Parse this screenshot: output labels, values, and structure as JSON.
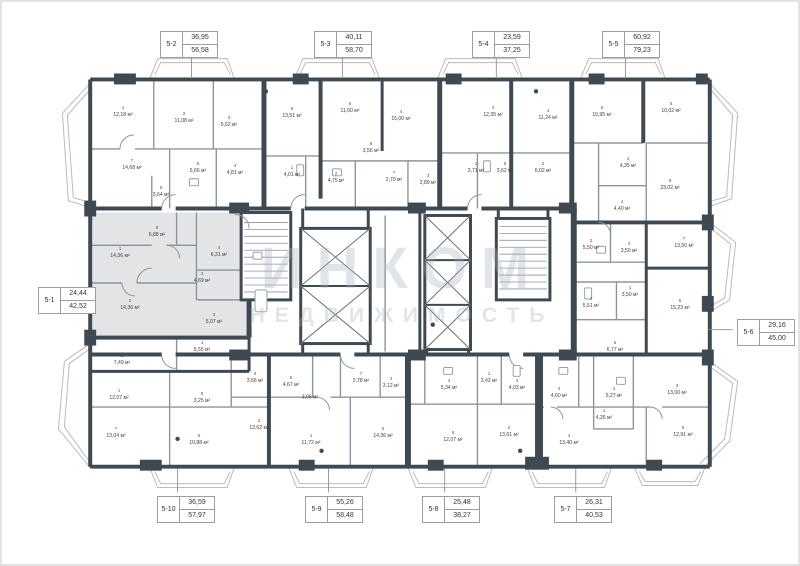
{
  "watermark": {
    "line1": "ИНКОМ",
    "line2": "НЕДВИЖИМОСТЬ"
  },
  "colors": {
    "wall": "#3e4951",
    "line": "#8d959c",
    "balcony": "#b6bcc2",
    "highlight": "#e3e4e6",
    "callout_border": "#9e9e9e",
    "watermark": "#a8b3bf"
  },
  "callouts": [
    {
      "id": "5-2",
      "top": "36,95",
      "bottom": "56,58",
      "x": 158,
      "y": 29,
      "leader": [
        190,
        55,
        190,
        77
      ]
    },
    {
      "id": "5-3",
      "top": "40,11",
      "bottom": "58,70",
      "x": 312,
      "y": 29,
      "leader": [
        342,
        55,
        342,
        77
      ]
    },
    {
      "id": "5-4",
      "top": "23,59",
      "bottom": "37,25",
      "x": 470,
      "y": 29,
      "leader": [
        497,
        55,
        497,
        77
      ]
    },
    {
      "id": "5-5",
      "top": "60,92",
      "bottom": "79,23",
      "x": 600,
      "y": 29,
      "leader": [
        627,
        55,
        627,
        77
      ]
    },
    {
      "id": "5-1",
      "top": "24,44",
      "bottom": "42,52",
      "x": 36,
      "y": 285,
      "leader": [
        92,
        298,
        87,
        298
      ]
    },
    {
      "id": "5-6",
      "top": "29,16",
      "bottom": "45,00",
      "x": 735,
      "y": 317,
      "leader": [
        735,
        330,
        711,
        330
      ]
    },
    {
      "id": "5-10",
      "top": "36,59",
      "bottom": "57,97",
      "x": 155,
      "y": 494,
      "leader": [
        176,
        494,
        176,
        470
      ]
    },
    {
      "id": "5-9",
      "top": "55,26",
      "bottom": "58,48",
      "x": 303,
      "y": 494,
      "leader": [
        328,
        494,
        328,
        470
      ]
    },
    {
      "id": "5-8",
      "top": "25,48",
      "bottom": "38,27",
      "x": 420,
      "y": 494,
      "leader": [
        445,
        494,
        445,
        470
      ]
    },
    {
      "id": "5-7",
      "top": "26,31",
      "bottom": "40,53",
      "x": 552,
      "y": 494,
      "leader": [
        577,
        494,
        577,
        470
      ]
    }
  ],
  "rooms": [
    {
      "n": "1",
      "area": "12,18 м²",
      "x": 121,
      "y": 110
    },
    {
      "n": "2",
      "area": "11,08 м²",
      "x": 182,
      "y": 116
    },
    {
      "n": "3",
      "area": "5,52 м²",
      "x": 227,
      "y": 120
    },
    {
      "n": "7",
      "area": "14,68 м²",
      "x": 130,
      "y": 163
    },
    {
      "n": "5",
      "area": "5,66 м²",
      "x": 196,
      "y": 166
    },
    {
      "n": "4",
      "area": "4,81 м²",
      "x": 233,
      "y": 168
    },
    {
      "n": "6",
      "area": "3,64 м²",
      "x": 159,
      "y": 190
    },
    {
      "n": "6",
      "area": "13,51 м²",
      "x": 290,
      "y": 111
    },
    {
      "n": "5",
      "area": "11,60 м²",
      "x": 348,
      "y": 106
    },
    {
      "n": "4",
      "area": "15,00 м²",
      "x": 399,
      "y": 114
    },
    {
      "n": "8",
      "area": "3,56 м²",
      "x": 369,
      "y": 146
    },
    {
      "n": "1",
      "area": "4,01 м²",
      "x": 290,
      "y": 170
    },
    {
      "n": "2",
      "area": "4,75 м²",
      "x": 334,
      "y": 176
    },
    {
      "n": "7",
      "area": "2,70 м²",
      "x": 392,
      "y": 175
    },
    {
      "n": "3",
      "area": "2,89 м²",
      "x": 426,
      "y": 178
    },
    {
      "n": "3",
      "area": "12,35 м²",
      "x": 491,
      "y": 110
    },
    {
      "n": "4",
      "area": "11,24 м²",
      "x": 546,
      "y": 113
    },
    {
      "n": "1",
      "area": "3,71 м²",
      "x": 474,
      "y": 166
    },
    {
      "n": "5",
      "area": "3,62 м²",
      "x": 503,
      "y": 166
    },
    {
      "n": "2",
      "area": "6,02 м²",
      "x": 541,
      "y": 166
    },
    {
      "n": "6",
      "area": "10,95 м²",
      "x": 600,
      "y": 110
    },
    {
      "n": "5",
      "area": "10,02 м²",
      "x": 669,
      "y": 106
    },
    {
      "n": "1",
      "area": "4,35 м²",
      "x": 626,
      "y": 161
    },
    {
      "n": "8",
      "area": "23,02 м²",
      "x": 668,
      "y": 183
    },
    {
      "n": "4",
      "area": "4,40 м²",
      "x": 620,
      "y": 204
    },
    {
      "n": "2",
      "area": "5,50 м²",
      "x": 589,
      "y": 243
    },
    {
      "n": "3",
      "area": "3,50 м²",
      "x": 627,
      "y": 246
    },
    {
      "n": "7",
      "area": "13,50 м²",
      "x": 682,
      "y": 241
    },
    {
      "n": "1",
      "area": "3,50 м²",
      "x": 628,
      "y": 290
    },
    {
      "n": "2",
      "area": "5,51 м²",
      "x": 589,
      "y": 301
    },
    {
      "n": "5",
      "area": "15,23 м²",
      "x": 678,
      "y": 303
    },
    {
      "n": "6",
      "area": "6,77 м²",
      "x": 613,
      "y": 345
    },
    {
      "n": "5",
      "area": "6,88 м²",
      "x": 155,
      "y": 230
    },
    {
      "n": "1",
      "area": "14,36 м²",
      "x": 118,
      "y": 251
    },
    {
      "n": "4",
      "area": "6,31 м²",
      "x": 217,
      "y": 250
    },
    {
      "n": "3",
      "area": "4,69 м²",
      "x": 200,
      "y": 276
    },
    {
      "n": "2",
      "area": "14,36 м²",
      "x": 128,
      "y": 303
    },
    {
      "n": "3",
      "area": "5,07 м²",
      "x": 212,
      "y": 317
    },
    {
      "n": "4",
      "area": "5,55 м²",
      "x": 200,
      "y": 345
    },
    {
      "n": "2",
      "area": "7,49 м²",
      "x": 120,
      "y": 358
    },
    {
      "n": "1",
      "area": "12,07 м²",
      "x": 117,
      "y": 393
    },
    {
      "n": "5",
      "area": "3,25 м²",
      "x": 200,
      "y": 396
    },
    {
      "n": "4",
      "area": "3,66 м²",
      "x": 253,
      "y": 376
    },
    {
      "n": "7",
      "area": "13,04 м²",
      "x": 114,
      "y": 431
    },
    {
      "n": "6",
      "area": "10,88 м²",
      "x": 197,
      "y": 438
    },
    {
      "n": "2",
      "area": "13,62 м²",
      "x": 257,
      "y": 423
    },
    {
      "n": "5",
      "area": "4,67 м²",
      "x": 289,
      "y": 380
    },
    {
      "n": "",
      "area": "3,06 м²",
      "x": 308,
      "y": 396
    },
    {
      "n": "7",
      "area": "2,78 м²",
      "x": 359,
      "y": 376
    },
    {
      "n": "3",
      "area": "3,12 м²",
      "x": 389,
      "y": 381
    },
    {
      "n": "1",
      "area": "11,72 м²",
      "x": 309,
      "y": 438
    },
    {
      "n": "6",
      "area": "14,36 м²",
      "x": 381,
      "y": 431
    },
    {
      "n": "4",
      "area": "5,34 м²",
      "x": 447,
      "y": 383
    },
    {
      "n": "1",
      "area": "3,42 м²",
      "x": 487,
      "y": 376
    },
    {
      "n": "3",
      "area": "4,03 м²",
      "x": 515,
      "y": 383
    },
    {
      "n": "5",
      "area": "12,07 м²",
      "x": 451,
      "y": 435
    },
    {
      "n": "2",
      "area": "13,61 м²",
      "x": 507,
      "y": 430
    },
    {
      "n": "3",
      "area": "4,60 м²",
      "x": 557,
      "y": 391
    },
    {
      "n": "2",
      "area": "5,27 м²",
      "x": 612,
      "y": 391
    },
    {
      "n": "1",
      "area": "4,26 м²",
      "x": 602,
      "y": 413
    },
    {
      "n": "4",
      "area": "13,40 м²",
      "x": 567,
      "y": 438
    },
    {
      "n": "3",
      "area": "13,00 м²",
      "x": 675,
      "y": 388
    },
    {
      "n": "5",
      "area": "12,91 м²",
      "x": 681,
      "y": 430
    }
  ]
}
